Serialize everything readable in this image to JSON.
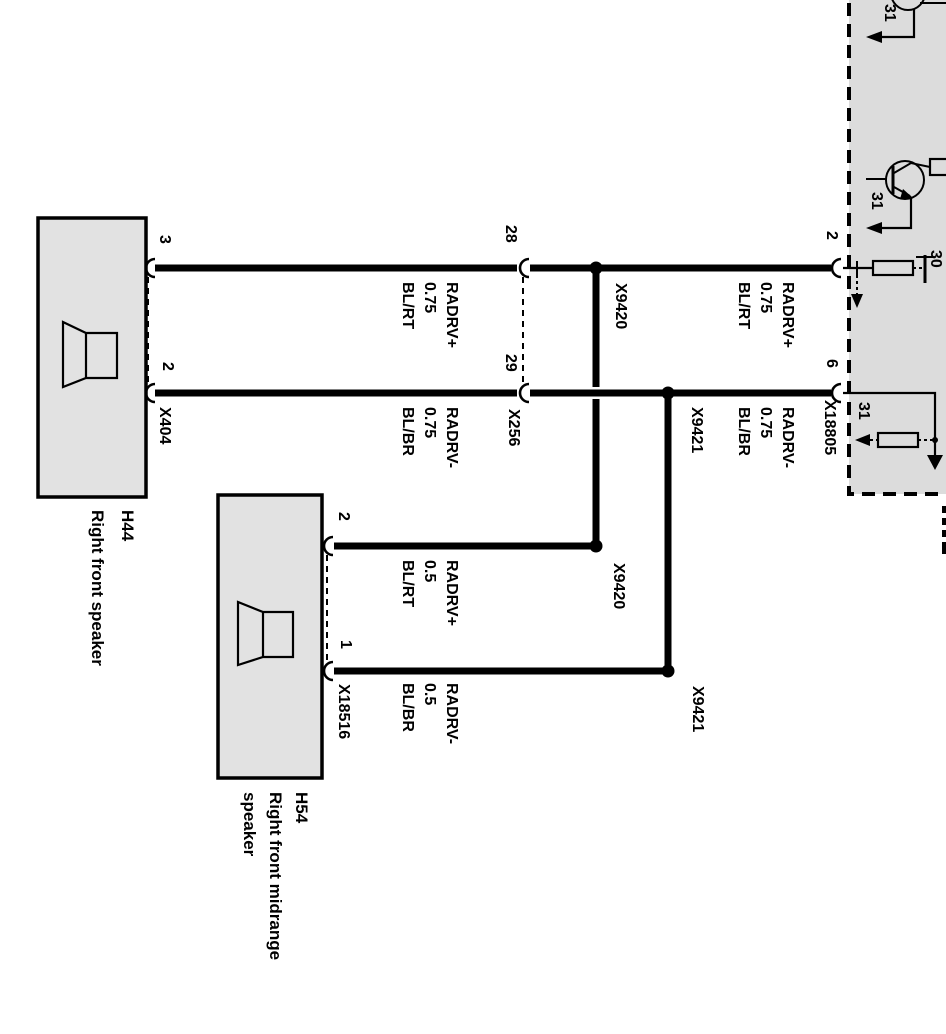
{
  "colors": {
    "background": "#ffffff",
    "component_fill": "#e2e2e2",
    "amplifier_fill": "#dcdcdc",
    "line": "#000000"
  },
  "h44": {
    "code": "H44",
    "label": "Right front speaker",
    "connector": "X404",
    "pin_plus": "3",
    "pin_minus": "2"
  },
  "h54": {
    "code": "H54",
    "label_line1": "Right front midrange",
    "label_line2": "speaker",
    "connector": "X18516",
    "pin_plus": "2",
    "pin_minus": "1"
  },
  "inline_connector": {
    "code": "X256",
    "pin_plus": "28",
    "pin_minus": "29"
  },
  "amplifier": {
    "connector": "X18805",
    "pin_plus": "2",
    "pin_minus": "6",
    "terminal_power": "30",
    "terminal_ground": "31"
  },
  "junction_plus": {
    "code": "X9420"
  },
  "junction_minus": {
    "code": "X9421"
  },
  "wires": {
    "w1_left": {
      "signal": "RADRV+",
      "gauge": "0.75",
      "color": "BL/RT"
    },
    "w1_right": {
      "signal": "RADRV+",
      "gauge": "0.75",
      "color": "BL/RT"
    },
    "w2_left": {
      "signal": "RADRV-",
      "gauge": "0.75",
      "color": "BL/BR"
    },
    "w2_right": {
      "signal": "RADRV-",
      "gauge": "0.75",
      "color": "BL/BR"
    },
    "w3": {
      "signal": "RADRV+",
      "gauge": "0.5",
      "color": "BL/RT"
    },
    "w4": {
      "signal": "RADRV-",
      "gauge": "0.5",
      "color": "BL/BR"
    }
  }
}
